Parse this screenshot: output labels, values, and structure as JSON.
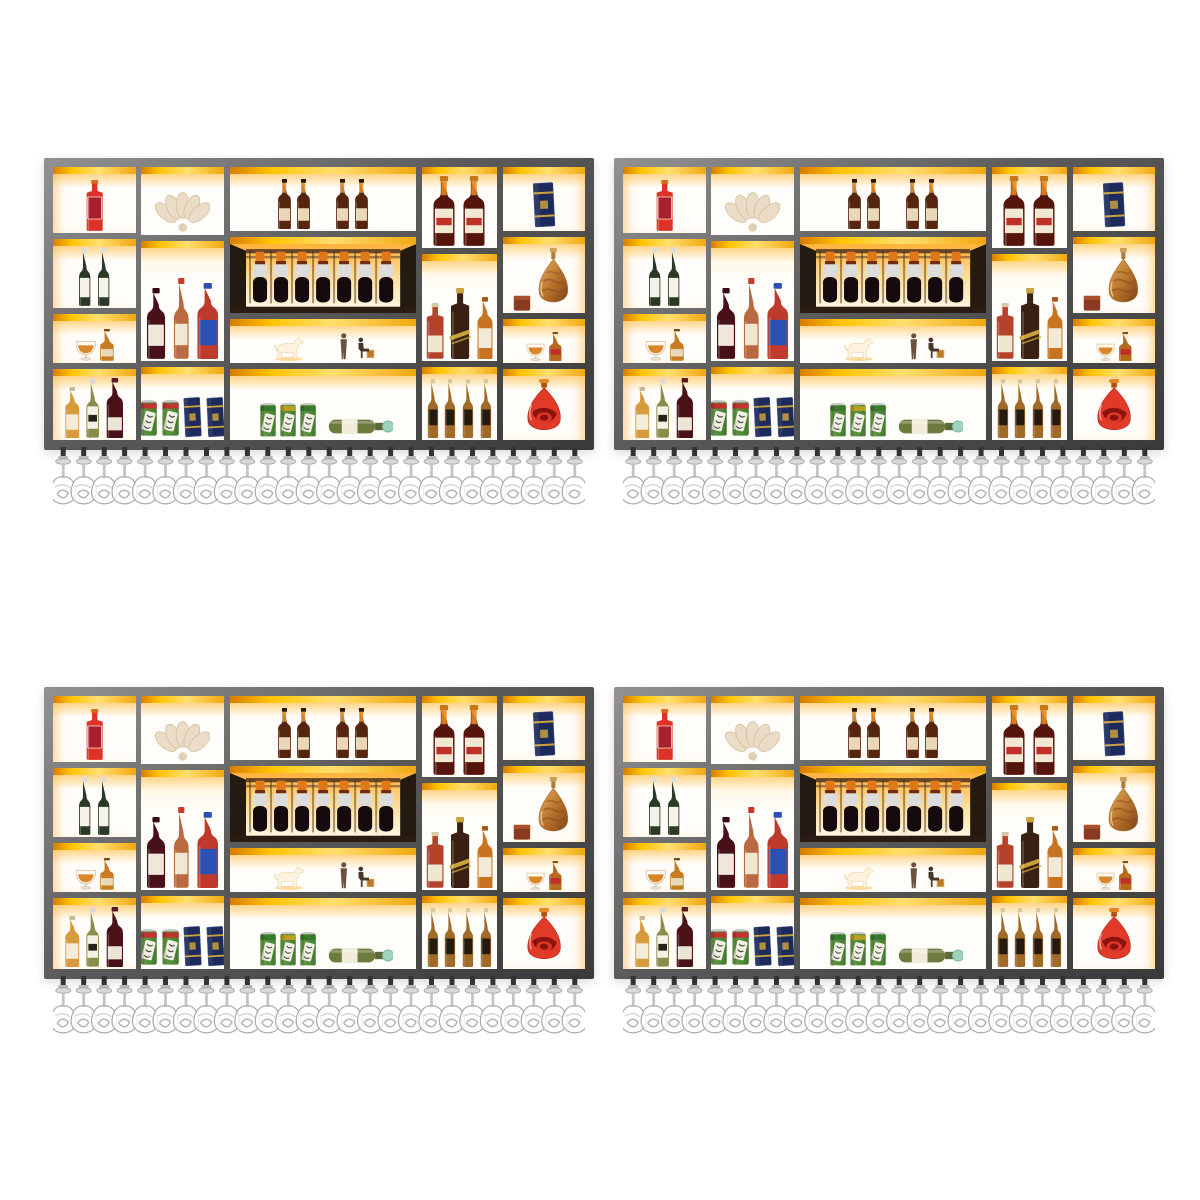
{
  "scene": {
    "background": "#ffffff",
    "description": "wall-mounted-bar-wine-rack-product-photo",
    "grid": {
      "rows": 2,
      "cols": 2
    },
    "units": [
      {
        "id": "shelf-unit-1",
        "x": 44,
        "y": 158
      },
      {
        "id": "shelf-unit-2",
        "x": 614,
        "y": 158
      },
      {
        "id": "shelf-unit-3",
        "x": 44,
        "y": 687
      },
      {
        "id": "shelf-unit-4",
        "x": 614,
        "y": 687
      }
    ],
    "unit": {
      "w": 550,
      "h": 292,
      "frame_top": 9,
      "frame_side": 9,
      "frame_bottom": 10,
      "cell_gap": 6
    }
  },
  "palette": {
    "frame_light": "#929292",
    "frame_dark": "#3a3a3a",
    "band_bright": "#ffc400",
    "band_deep": "#d97c00",
    "cell_bg": "#fffdf9",
    "glow": "#ffba40",
    "glass_stroke": "#a8a8a8",
    "chrome": "#c4c4c4"
  },
  "glass_rack": {
    "count": 26,
    "height": 64
  },
  "columns": [
    {
      "name": "column-1",
      "w": 0.155,
      "cells": [
        {
          "name": "cell-red-liqueur",
          "h": 0.26,
          "items": [
            {
              "t": "bottle",
              "shape": "square",
              "hf": 0.92,
              "ar": 0.42,
              "body": "#dc3227",
              "cap": "#d86a20",
              "label": "#a82030",
              "labelStroke": "#f0d0b8",
              "ly": 40,
              "lh": 52
            }
          ]
        },
        {
          "name": "cell-white-wine-pair",
          "h": 0.27,
          "items": [
            {
              "t": "bottle",
              "shape": "slender",
              "hf": 1,
              "ar": 0.3,
              "body": "#2b3a26",
              "cap": "#d8dde0",
              "label": "#f5f2ea",
              "ly": 62,
              "lh": 40
            },
            {
              "t": "bottle",
              "shape": "slender",
              "hf": 1,
              "ar": 0.3,
              "body": "#2b3a26",
              "cap": "#d8dde0",
              "label": "#f5f2ea",
              "ly": 62,
              "lh": 40
            }
          ]
        },
        {
          "name": "cell-cognac-set-left",
          "h": 0.19,
          "items": [
            {
              "t": "snifter",
              "hf": 0.6
            },
            {
              "t": "bottle",
              "shape": "squat",
              "hf": 0.85,
              "ar": 0.5,
              "body": "#c67d22",
              "cap": "#7a4a10",
              "label": "#e9d9b8",
              "ly": 76,
              "lh": 28
            }
          ]
        },
        {
          "name": "cell-wine-trio-left",
          "h": 0.28,
          "items": [
            {
              "t": "bottle",
              "shape": "standard",
              "hf": 0.85,
              "ar": 0.36,
              "body": "#d79a3c",
              "cap": "#c8b890",
              "label": "#f2ecdc",
              "ly": 64,
              "lh": 36
            },
            {
              "t": "bottle",
              "shape": "slender",
              "hf": 0.97,
              "ar": 0.33,
              "body": "#8a8c4a",
              "cap": "#d8d8d8",
              "label": "#f4f2e8",
              "ly": 56,
              "lh": 46,
              "band": "#26231c"
            },
            {
              "t": "bottle",
              "shape": "standard",
              "hf": 1,
              "ar": 0.36,
              "body": "#4a1119",
              "cap": "#5a1a20",
              "label": "#ece4d4",
              "ly": 78,
              "lh": 26
            }
          ]
        }
      ]
    },
    {
      "name": "column-2",
      "w": 0.155,
      "cells": [
        {
          "name": "cell-shell-ornament",
          "h": 0.26,
          "items": [
            {
              "t": "shell",
              "hf": 0.75
            }
          ]
        },
        {
          "name": "cell-liquor-trio",
          "h": 0.46,
          "items": [
            {
              "t": "bottle",
              "shape": "standard",
              "hf": 0.65,
              "ar": 0.34,
              "body": "#481018",
              "cap": "#3a0c12",
              "label": "#efe8da",
              "ly": 62,
              "lh": 36
            },
            {
              "t": "bottle",
              "shape": "slender",
              "hf": 0.74,
              "ar": 0.28,
              "body": "#b96a40",
              "cap": "#c23c2c",
              "label": "#f0e6d2",
              "ly": 68,
              "lh": 32
            },
            {
              "t": "bottle",
              "shape": "standard",
              "hf": 0.7,
              "ar": 0.36,
              "body": "#bf3a2c",
              "cap": "#2b50b4",
              "label": "#2b50b4",
              "ly": 58,
              "lh": 40
            }
          ]
        },
        {
          "name": "cell-cans-and-giftboxes",
          "h": 0.28,
          "items": [
            {
              "t": "can",
              "hf": 0.62,
              "top": "#c23430"
            },
            {
              "t": "can",
              "hf": 0.62,
              "top": "#c23430"
            },
            {
              "t": "giftbox",
              "hf": 0.68,
              "ar": 0.5
            },
            {
              "t": "giftbox",
              "hf": 0.68,
              "ar": 0.5
            }
          ]
        }
      ]
    },
    {
      "name": "column-3",
      "w": 0.35,
      "cells": [
        {
          "name": "cell-brandy-row",
          "h": 0.25,
          "items": [
            {
              "t": "bottle",
              "shape": "standard",
              "hf": 0.95,
              "ar": 0.34,
              "body": "#56250f",
              "cap": "#2e1206",
              "neckGlow": "#e08a28",
              "label": "#e8d7b8",
              "ly": 70,
              "lh": 30
            },
            {
              "t": "bottle",
              "shape": "standard",
              "hf": 0.95,
              "ar": 0.34,
              "body": "#56250f",
              "cap": "#2e1206",
              "neckGlow": "#e08a28",
              "label": "#e8d7b8",
              "ly": 70,
              "lh": 30
            },
            {
              "t": "gap",
              "w": 18
            },
            {
              "t": "bottle",
              "shape": "standard",
              "hf": 0.95,
              "ar": 0.34,
              "body": "#56250f",
              "cap": "#2e1206",
              "neckGlow": "#e08a28",
              "label": "#e8d7b8",
              "ly": 70,
              "lh": 30
            },
            {
              "t": "bottle",
              "shape": "standard",
              "hf": 0.95,
              "ar": 0.34,
              "body": "#56250f",
              "cap": "#2e1206",
              "neckGlow": "#e08a28",
              "label": "#e8d7b8",
              "ly": 70,
              "lh": 30
            }
          ]
        },
        {
          "name": "cell-wine-rack",
          "h": 0.3,
          "rack": {
            "bottles": 7,
            "cap": "#e07818",
            "ring": "#702c10",
            "band": "#dcdcda",
            "body": "#150a0e",
            "wood": "#6a4526",
            "side": "#241a12",
            "shelf": "#2a1c12"
          }
        },
        {
          "name": "cell-figurines",
          "h": 0.17,
          "items": [
            {
              "t": "horse",
              "hf": 0.78
            },
            {
              "t": "gap",
              "w": 26
            },
            {
              "t": "person-standing",
              "hf": 0.85
            },
            {
              "t": "gap",
              "w": 2
            },
            {
              "t": "person-seated",
              "hf": 0.72
            }
          ]
        },
        {
          "name": "cell-cans-lying-bottle",
          "h": 0.28,
          "items": [
            {
              "t": "gap",
              "w": 18
            },
            {
              "t": "can",
              "hf": 0.6,
              "top": "#3a7a2e"
            },
            {
              "t": "can",
              "hf": 0.6,
              "top": "#b8a020"
            },
            {
              "t": "can",
              "hf": 0.6,
              "top": "#3a7a2e"
            },
            {
              "t": "gap",
              "w": 6
            },
            {
              "t": "lying-bottle",
              "hf": 0.38
            },
            {
              "t": "gap",
              "w": 12
            }
          ]
        }
      ]
    },
    {
      "name": "column-4",
      "w": 0.14,
      "cells": [
        {
          "name": "cell-champagne-pair",
          "h": 0.31,
          "items": [
            {
              "t": "bottle",
              "shape": "standard",
              "hf": 1,
              "ar": 0.4,
              "body": "#55150c",
              "cap": "#c87818",
              "neckGlow": "#e8871f",
              "label": "#f0e8d2",
              "ly": 56,
              "lh": 42,
              "band": "#c03028"
            },
            {
              "t": "bottle",
              "shape": "standard",
              "hf": 1,
              "ar": 0.4,
              "body": "#55150c",
              "cap": "#c87818",
              "neckGlow": "#e8871f",
              "label": "#f0e8d2",
              "ly": 56,
              "lh": 42,
              "band": "#c03028"
            }
          ]
        },
        {
          "name": "cell-whisky-trio",
          "h": 0.41,
          "items": [
            {
              "t": "bottle",
              "shape": "square",
              "hf": 0.58,
              "ar": 0.4,
              "body": "#b5432c",
              "cap": "#d8c8a8",
              "label": "#efe6d0",
              "ly": 70,
              "lh": 36
            },
            {
              "t": "bottle",
              "shape": "square",
              "hf": 0.74,
              "ar": 0.34,
              "body": "#3a2013",
              "cap": "#caa23c",
              "diag": "#caa23c"
            },
            {
              "t": "bottle",
              "shape": "standard",
              "hf": 0.65,
              "ar": 0.32,
              "body": "#c8731f",
              "cap": "#a85a14",
              "label": "#f2ead8",
              "ly": 60,
              "lh": 38
            }
          ]
        },
        {
          "name": "cell-whiskey-bottles",
          "h": 0.28,
          "items": [
            {
              "t": "bottle",
              "shape": "slender",
              "hf": 0.95,
              "ar": 0.27,
              "body": "#a06a28",
              "cap": "#d8c8a0",
              "label": "#241a10",
              "ly": 62,
              "lh": 32
            },
            {
              "t": "bottle",
              "shape": "slender",
              "hf": 0.95,
              "ar": 0.27,
              "body": "#a06a28",
              "cap": "#d8c8a0",
              "label": "#241a10",
              "ly": 62,
              "lh": 32
            },
            {
              "t": "bottle",
              "shape": "slender",
              "hf": 0.95,
              "ar": 0.27,
              "body": "#a06a28",
              "cap": "#d8c8a0",
              "label": "#241a10",
              "ly": 62,
              "lh": 32
            },
            {
              "t": "bottle",
              "shape": "slender",
              "hf": 0.95,
              "ar": 0.27,
              "body": "#a06a28",
              "cap": "#d8c8a0",
              "label": "#241a10",
              "ly": 62,
              "lh": 32
            }
          ]
        }
      ]
    },
    {
      "name": "column-5",
      "w": 0.155,
      "cells": [
        {
          "name": "cell-navy-gift-box",
          "h": 0.25,
          "items": [
            {
              "t": "giftbox",
              "hf": 0.9,
              "ar": 0.55
            }
          ]
        },
        {
          "name": "cell-amber-decanter",
          "h": 0.3,
          "items": [
            {
              "t": "mini-box",
              "hf": 0.25
            },
            {
              "t": "decanter",
              "hf": 0.97
            }
          ]
        },
        {
          "name": "cell-cognac-set-right",
          "h": 0.17,
          "items": [
            {
              "t": "snifter",
              "hf": 0.62
            },
            {
              "t": "bottle",
              "shape": "squat",
              "hf": 0.9,
              "ar": 0.5,
              "body": "#b86a1c",
              "cap": "#8a4a10",
              "label": "#c03028",
              "ly": 70,
              "lh": 24
            }
          ]
        },
        {
          "name": "cell-red-decanter",
          "h": 0.28,
          "items": [
            {
              "t": "teardrop",
              "hf": 0.97
            }
          ]
        }
      ]
    }
  ]
}
